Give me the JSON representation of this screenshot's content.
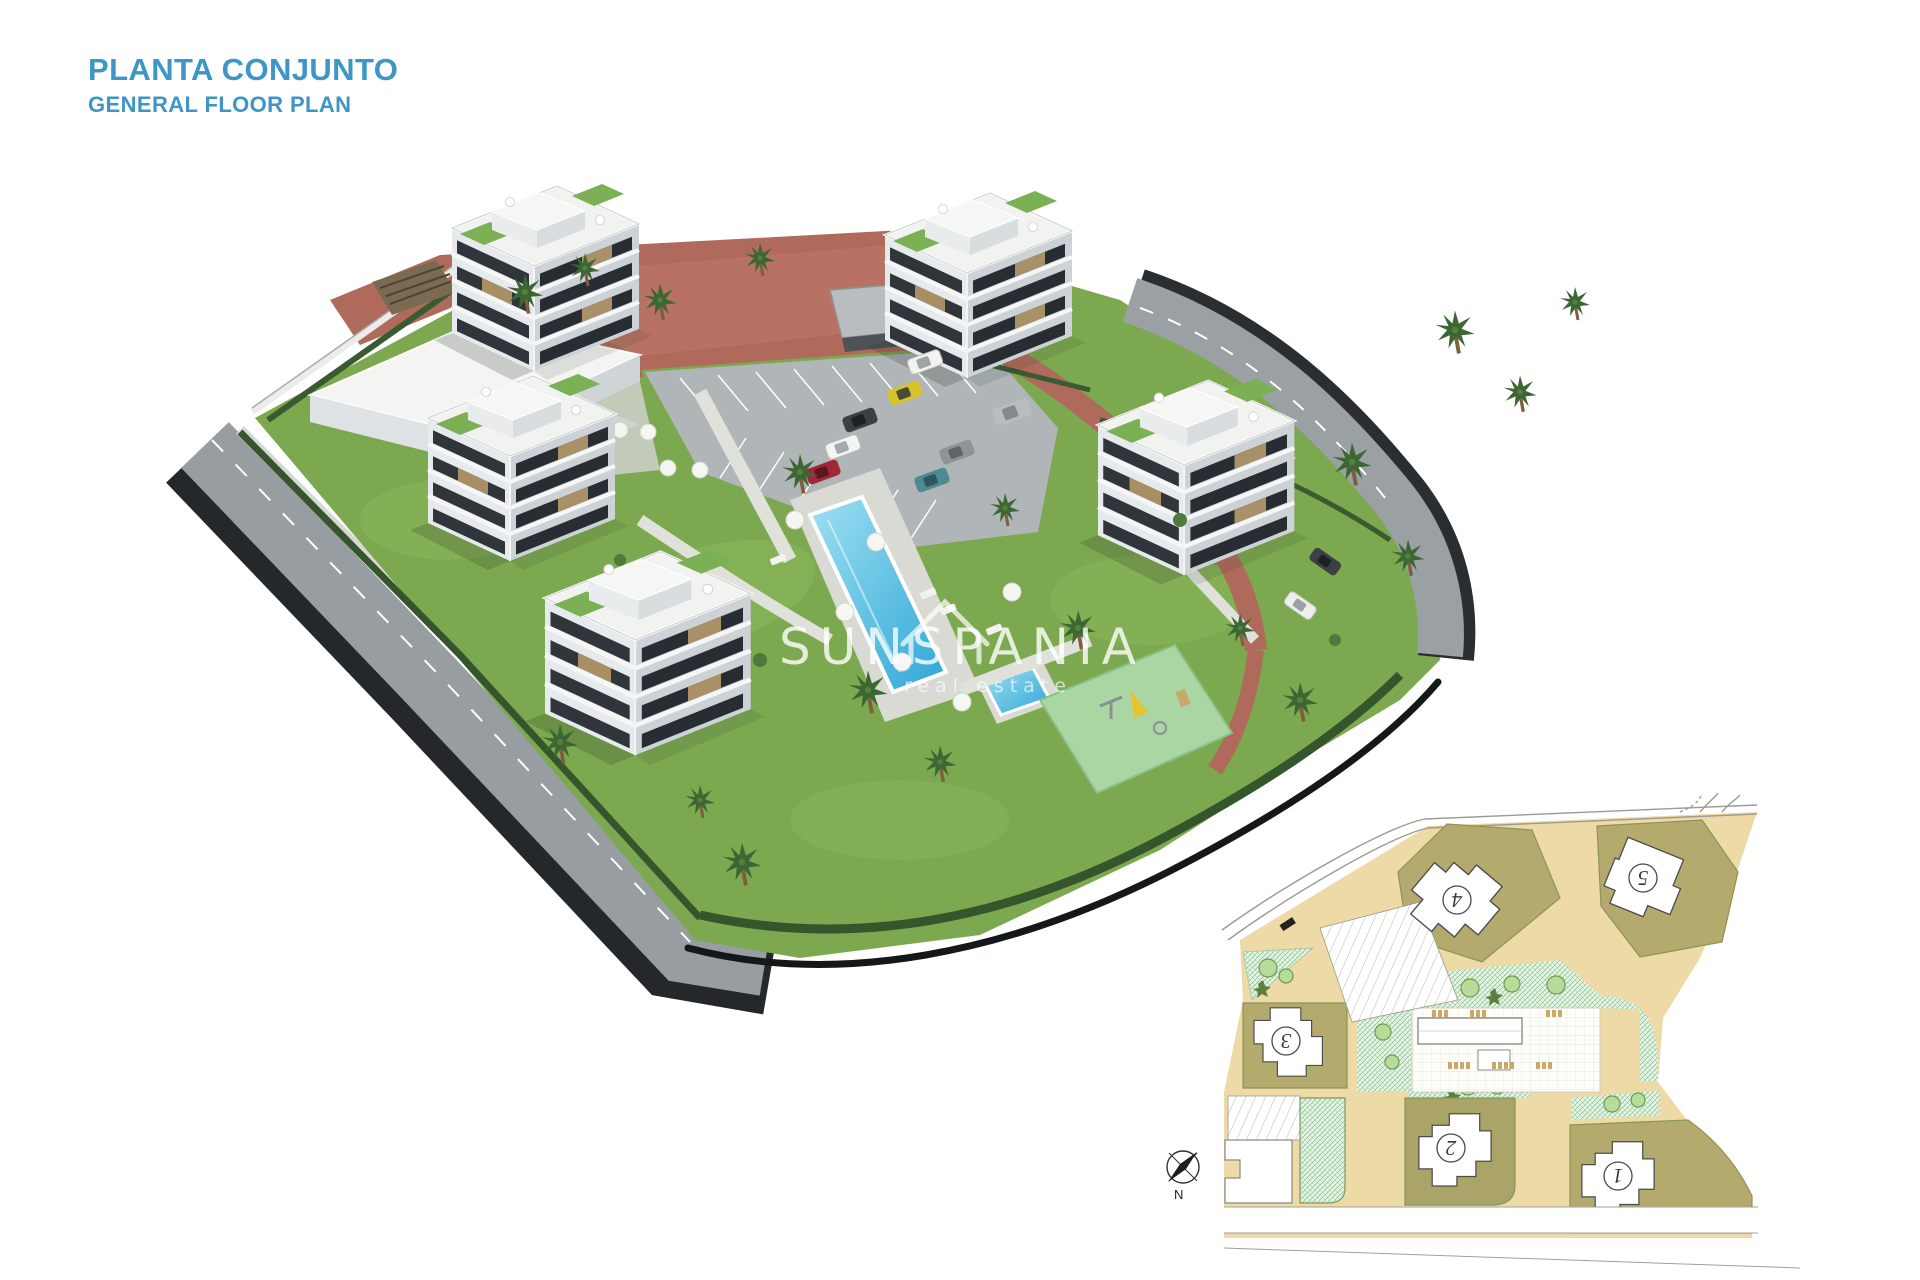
{
  "header": {
    "title": "PLANTA CONJUNTO",
    "subtitle": "GENERAL FLOOR PLAN"
  },
  "watermark": {
    "brand": "SUNSPANIA",
    "tagline": "real estate"
  },
  "inset": {
    "compass_label": "N",
    "buildings": [
      {
        "label": "1"
      },
      {
        "label": "2"
      },
      {
        "label": "3"
      },
      {
        "label": "4"
      },
      {
        "label": "5"
      }
    ]
  },
  "colors": {
    "accent_blue": "#3D96C5",
    "grass_green": "#7CA94F",
    "pool_water": "#49B8DE",
    "brick_path": "#B06A5C",
    "asphalt_road": "#9AA0A4",
    "plan_road_tan": "#EEDAA6",
    "plan_plot_khaki": "#B5AA6E",
    "watermark_white": "#FFFFFF"
  }
}
